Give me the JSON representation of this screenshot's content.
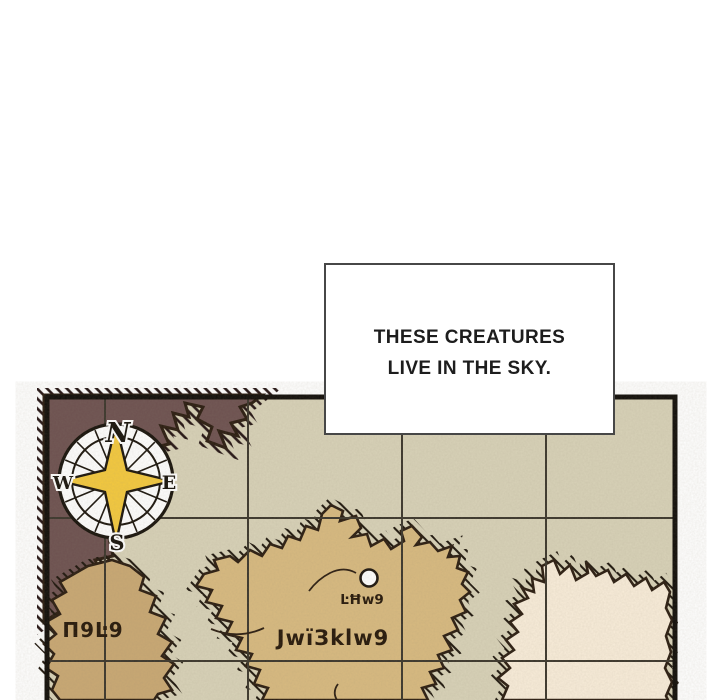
{
  "caption_box": {
    "line1": "THESE CREATURES",
    "line2": "LIVE IN THE SKY."
  },
  "map": {
    "compass": {
      "north": "N",
      "east": "E",
      "south": "S",
      "west": "W"
    },
    "labels": {
      "island_left": "П9Ŀ9",
      "settlement": "ĿĦw9",
      "island_center": "JwïЗklw9"
    },
    "colors": {
      "sea": "#d8d2b8",
      "grid": "#3b362c",
      "border": "#100d09",
      "landmass_dark": "#6d5150",
      "island_left": "#c9a873",
      "island_center": "#d8ba80",
      "island_right": "#f9edda",
      "coast_outline": "#2a1c10",
      "star": "#f4c93e",
      "label_text": "#251709"
    }
  }
}
